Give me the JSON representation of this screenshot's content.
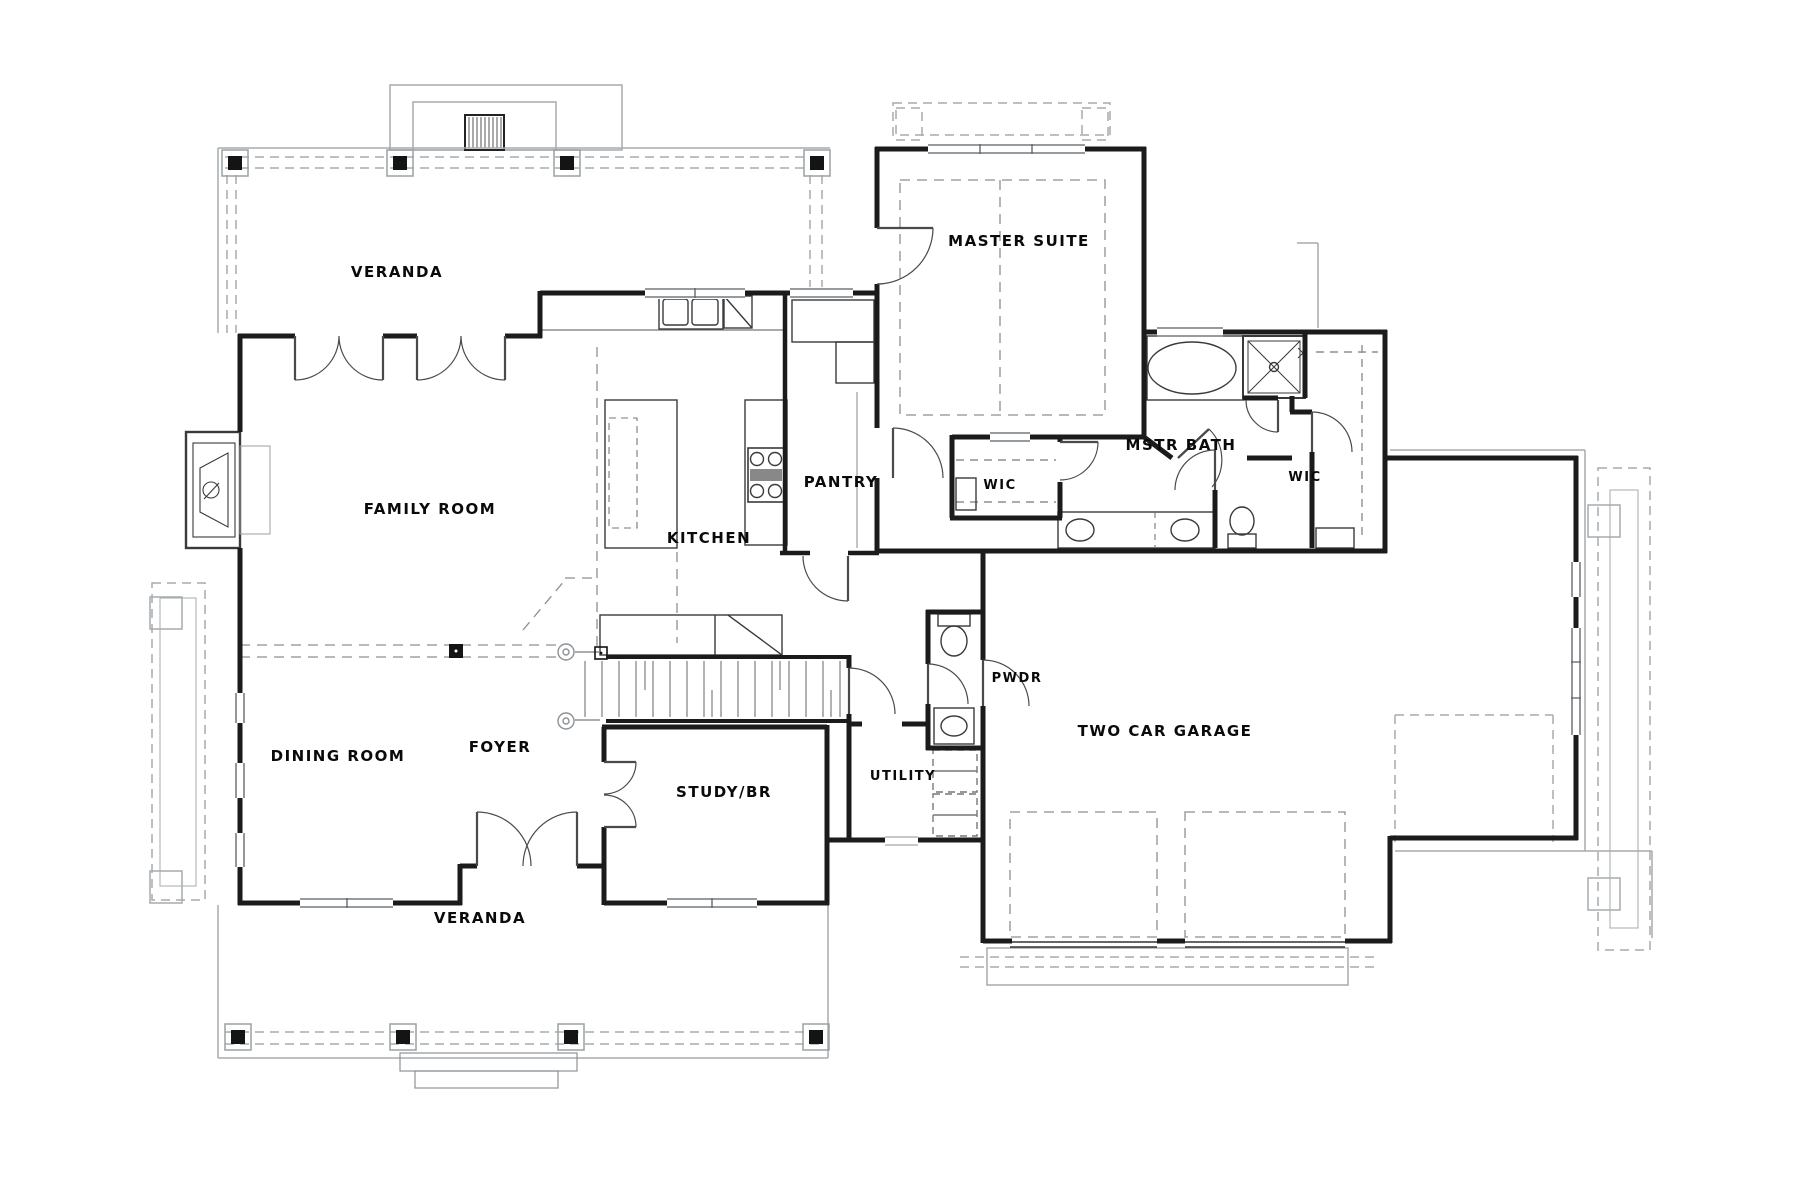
{
  "drawing": {
    "type": "residential floor plan",
    "palette": {
      "ink": "#1b1b1b",
      "fixture": "#3a3a3a",
      "door": "#444444",
      "site_gray": "#a6abae",
      "dash_gray": "#8b9094",
      "paper": "#ffffff"
    }
  },
  "rooms": [
    {
      "id": "veranda-top",
      "label": "VERANDA"
    },
    {
      "id": "master-suite",
      "label": "MASTER SUITE"
    },
    {
      "id": "family-room",
      "label": "FAMILY ROOM"
    },
    {
      "id": "kitchen",
      "label": "KITCHEN"
    },
    {
      "id": "pantry",
      "label": "PANTRY"
    },
    {
      "id": "mstr-bath",
      "label": "MSTR BATH"
    },
    {
      "id": "wic-left",
      "label": "WIC"
    },
    {
      "id": "wic-right",
      "label": "WIC"
    },
    {
      "id": "dining-room",
      "label": "DINING ROOM"
    },
    {
      "id": "foyer",
      "label": "FOYER"
    },
    {
      "id": "study-br",
      "label": "STUDY/BR"
    },
    {
      "id": "utility",
      "label": "UTILITY"
    },
    {
      "id": "pwdr",
      "label": "PWDR"
    },
    {
      "id": "two-car-garage",
      "label": "TWO CAR GARAGE"
    },
    {
      "id": "veranda-bottom",
      "label": "VERANDA"
    }
  ]
}
